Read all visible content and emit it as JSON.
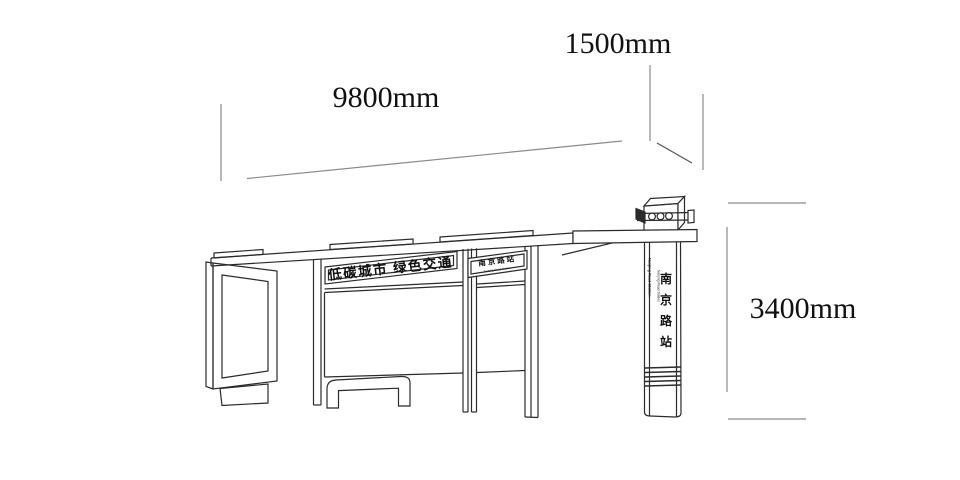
{
  "drawing": {
    "type": "bus-shelter-dimension-diagram",
    "background_color": "#ffffff",
    "line_color": "#2b2b2b",
    "dim_line_color": "#8a8a8a"
  },
  "dimensions": {
    "length_label": "9800mm",
    "depth_label": "1500mm",
    "height_label": "3400mm"
  },
  "shelter": {
    "main_sign_text": "低碳城市 绿色交通",
    "station_sign_cn": "南京路站",
    "station_sign_en": "Nanjing Road Station"
  },
  "pole": {
    "station_chars": [
      "南",
      "京",
      "路",
      "站"
    ],
    "station_en": "Nanjing Road Station"
  }
}
